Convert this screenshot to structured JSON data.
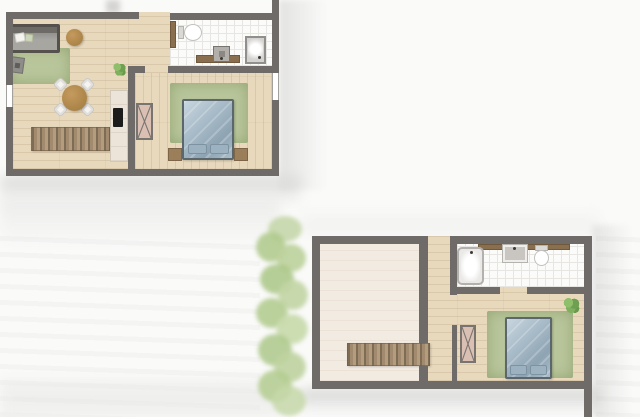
{
  "document": {
    "type": "architectural-floor-plan-sheet",
    "style": "top-down watercolor render, no text labels",
    "plans_count": 2
  },
  "palette": {
    "paper": "#fafaf9",
    "wall": "#6e6b68",
    "wood_floor": "#e8d9bd",
    "wood_floor_pale": "#f2ebe2",
    "tile": "#fbfbfa",
    "rug": "#b9c69c",
    "stairs_dark": "#7f6c55",
    "stairs_light": "#b49c7e",
    "bed_frame": "#5c666d",
    "duvet": "#a9bcc9",
    "pillow": "#9db2c0",
    "wardrobe": "#d9c0b3",
    "wardrobe_line": "#7a7470",
    "sofa": "#55524d",
    "sofa_seat": "#a8a6a1",
    "table_wood": "#9f7a3f",
    "plant": "#6fa052",
    "counter": "#ece4d9",
    "counter_wood": "#8a6f4e",
    "cooktop": "#1c1c1c",
    "greenery": "#b3c98e"
  },
  "upper_plan": {
    "name": "upper floor plan",
    "position": "top-left of sheet",
    "rooms": [
      {
        "name": "living-dining-kitchen",
        "floor": "light wood planks (horizontal)",
        "furniture": [
          "sofa with white cushion",
          "green area rug",
          "ottoman",
          "round coffee table",
          "potted plant",
          "round dining table",
          "four white chairs",
          "staircase",
          "kitchen counter with dark cooktop"
        ]
      },
      {
        "name": "entry-hall",
        "floor": "wood",
        "features": [
          "entry opening in top wall"
        ]
      },
      {
        "name": "bathroom",
        "floor": "white tile",
        "furniture": [
          "toilet with wood panel",
          "vanity counter with sink",
          "shower"
        ]
      },
      {
        "name": "bedroom",
        "floor": "wood planks (vertical)",
        "furniture": [
          "double bed with blue duvet and two pillows",
          "two nightstands",
          "green area rug",
          "wardrobe with X symbol"
        ]
      }
    ],
    "openings": [
      "entry gap in top wall",
      "bedroom door gap in interior wall",
      "window in left wall",
      "window in right wall"
    ]
  },
  "lower_plan": {
    "name": "lower floor plan",
    "position": "bottom-right of sheet",
    "rooms": [
      {
        "name": "large-room-with-void",
        "floor": "pale cream planks",
        "furniture": [
          "staircase crossing right wall opening"
        ]
      },
      {
        "name": "hallway",
        "floor": "wood",
        "features": [
          "entry opening in top wall"
        ]
      },
      {
        "name": "bathroom",
        "floor": "white tile",
        "furniture": [
          "bathtub",
          "sink with white rim",
          "toilet",
          "wood counter strip along top wall"
        ]
      },
      {
        "name": "bedroom",
        "floor": "wood planks",
        "furniture": [
          "double bed with blue duvet and two pillows",
          "green area rug",
          "potted plant",
          "wardrobe with X symbol"
        ]
      }
    ],
    "openings": [
      "entry gap in top wall",
      "bathroom door gap in bottom wall",
      "bedroom opening from hallway"
    ]
  },
  "environment": {
    "greenery": "watercolor shrub strip along left edge of lower plan",
    "background": "soft gray watercolor washes around both plans"
  }
}
